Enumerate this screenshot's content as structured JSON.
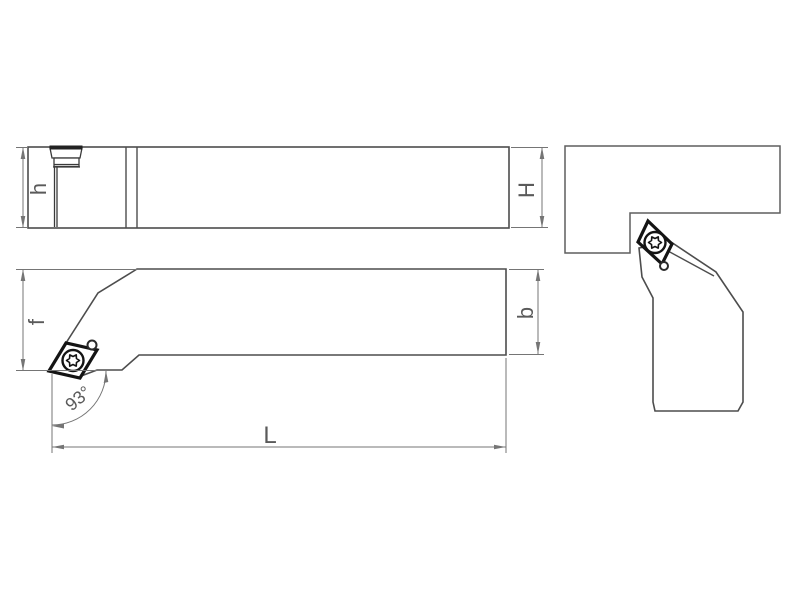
{
  "diagram": {
    "labels": {
      "h": "h",
      "H": "H",
      "f": "f",
      "b": "b",
      "L": "L",
      "angle": "93°"
    },
    "colors": {
      "background": "#ffffff",
      "outline": "#4d4d4d",
      "dimension": "#757575",
      "insert_edge": "#141414",
      "label_text": "#5a5a5a"
    }
  }
}
